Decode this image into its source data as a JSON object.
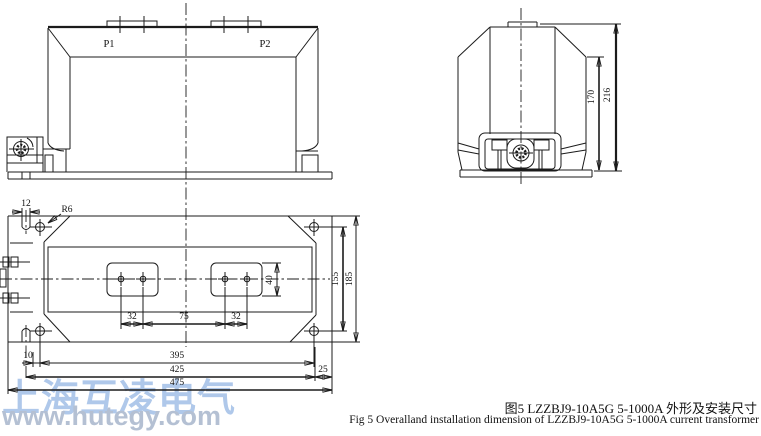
{
  "front_view": {
    "label_p1": "P1",
    "label_p2": "P2"
  },
  "side_view": {
    "dim_shoulder_height": "170",
    "dim_total_height": "216"
  },
  "plan_view": {
    "dim_slot_width": "12",
    "label_corner_radius": "R6",
    "dim_pad_hole_pitch_left": "32",
    "dim_pad_gap": "75",
    "dim_pad_hole_pitch_right": "32",
    "dim_pad_height": "40",
    "dim_hole_pitch_vertical": "155",
    "dim_plate_depth": "185",
    "dim_slot_to_hole": "10",
    "dim_hole_pitch_horizontal": "395",
    "dim_inner_width": "425",
    "dim_edge_margin": "25",
    "dim_total_width": "475"
  },
  "caption": {
    "line_zh": "图5 LZZBJ9-10A5G  5-1000A 外形及安装尺寸",
    "line_en": "Fig 5 Overalland installation dimension of LZZBJ9-10A5G 5-1000A  current transformer"
  },
  "watermark": {
    "company": "上海互凌电气",
    "website": "www.hutegy.com"
  },
  "colors": {
    "line": "#1b1b1b",
    "watermark_company": "#afc8ea",
    "watermark_site": "#b4c0d3"
  }
}
